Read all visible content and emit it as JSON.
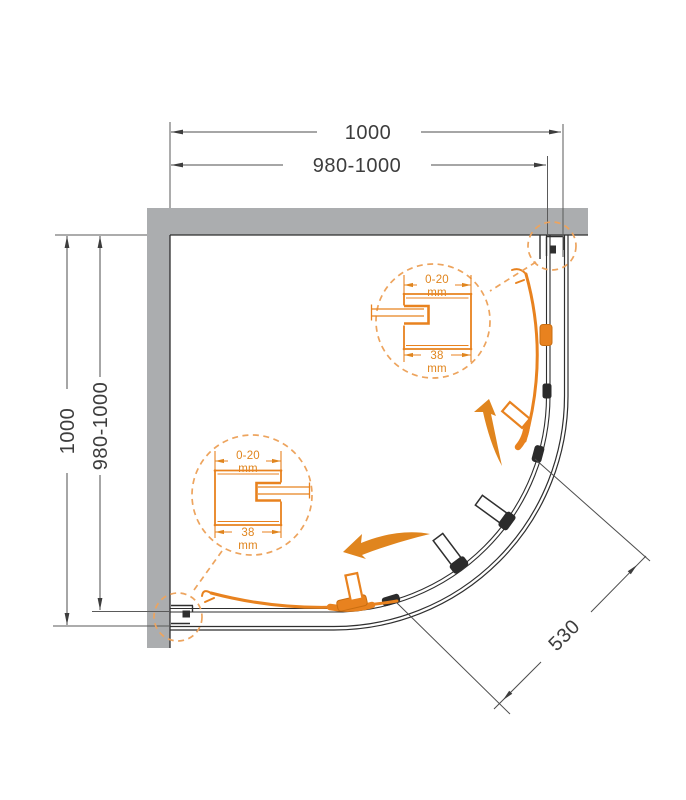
{
  "diagram": {
    "type": "technical-drawing",
    "subject": "quarter-round corner shower enclosure - top view installation diagram",
    "colors": {
      "accent_orange": "#e8821f",
      "accent_orange_light": "#eda45e",
      "wall_gray": "#abadaf",
      "line_black": "#2f2f2f",
      "dim_text": "#3d3d3d"
    },
    "dims": {
      "top_total": "1000",
      "top_adjustable": "980-1000",
      "left_total": "1000",
      "left_adjustable": "980-1000",
      "entry_width": "530"
    },
    "detail_upper": {
      "range": "0-20",
      "range_unit": "mm",
      "depth": "38",
      "depth_unit": "mm"
    },
    "detail_lower": {
      "range": "0-20",
      "range_unit": "mm",
      "depth": "38",
      "depth_unit": "mm"
    }
  }
}
